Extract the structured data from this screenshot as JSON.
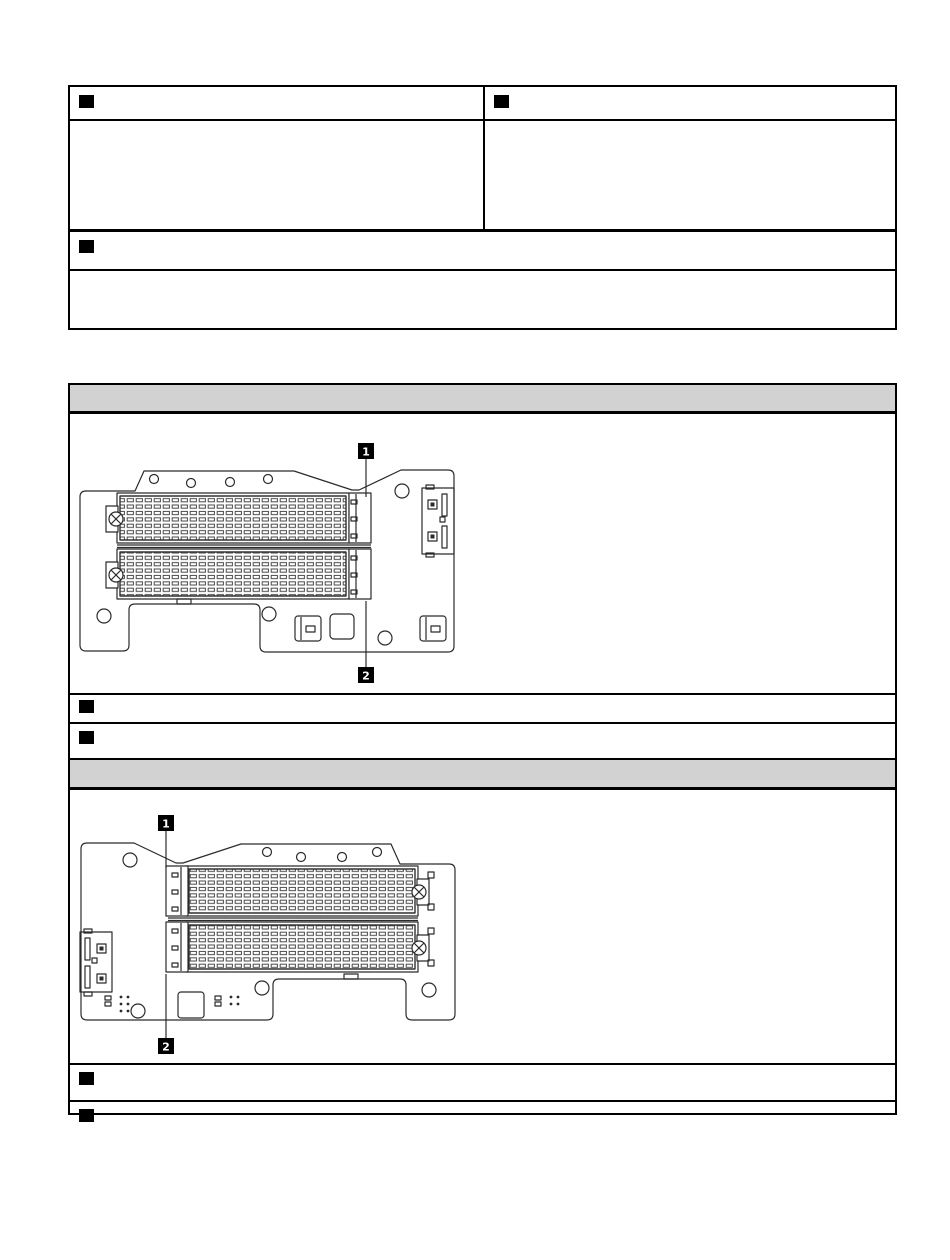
{
  "colors": {
    "page_background": "#ffffff",
    "table_border": "#000000",
    "section_header_fill": "#d2d2d2",
    "callout_marker_fill": "#000000",
    "diagram_line": "#2b2b2b",
    "callout_box_fill": "#000000",
    "callout_number_color": "#ffffff"
  },
  "table1": {
    "rows": [
      {
        "name": "header-two-columns",
        "cells": [
          "callout-marker",
          "callout-marker"
        ],
        "text": [
          "",
          ""
        ]
      },
      {
        "name": "body-two-columns",
        "text": [
          "",
          ""
        ]
      },
      {
        "name": "header-full-span",
        "cells": [
          "callout-marker"
        ],
        "text": [
          ""
        ]
      },
      {
        "name": "body-full-span",
        "text": [
          ""
        ]
      }
    ]
  },
  "table2": {
    "section1": {
      "header_text": "",
      "marker_rows": [
        {
          "cells": [
            "callout-marker"
          ],
          "text": ""
        },
        {
          "cells": [
            "callout-marker"
          ],
          "text": ""
        }
      ]
    },
    "section2": {
      "header_text": "",
      "marker_rows": [
        {
          "cells": [
            "callout-marker"
          ],
          "text": ""
        },
        {
          "cells": [
            "callout-marker"
          ],
          "text": ""
        }
      ]
    }
  },
  "diagrams": [
    {
      "name": "m2-adapter-assembly-front-view",
      "callouts": [
        {
          "label": "1"
        },
        {
          "label": "2"
        }
      ]
    },
    {
      "name": "m2-adapter-assembly-rear-view",
      "callouts": [
        {
          "label": "1"
        },
        {
          "label": "2"
        }
      ]
    }
  ]
}
